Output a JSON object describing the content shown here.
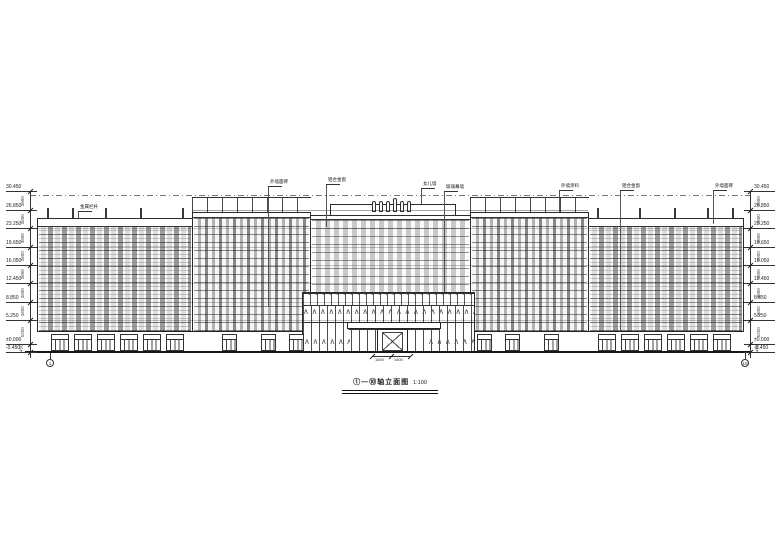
{
  "title": {
    "text": "①—⑩轴立面图",
    "scale": "1:100"
  },
  "elevations": [
    "30.450",
    "26.850",
    "23.250",
    "19.650",
    "16.050",
    "12.450",
    "8.850",
    "5.250",
    "±0.000",
    "-0.450"
  ],
  "dim_segments": [
    "3600",
    "3600",
    "3600",
    "3600",
    "3600",
    "3600",
    "3600",
    "5250",
    "450"
  ],
  "callouts": [
    "金属栏杆",
    "外墙面砖",
    "铝合金窗",
    "女儿墙",
    "玻璃幕墙",
    "外墙涂料",
    "铝合金窗",
    "外墙面砖"
  ],
  "entrance_dims": [
    "1800",
    "1800"
  ],
  "axis_bubbles": {
    "left": "1",
    "right": "10"
  },
  "colors": {
    "line": "#2b2b2b",
    "glazing_dark": "#878787",
    "glazing_light": "#c9c9c9"
  }
}
